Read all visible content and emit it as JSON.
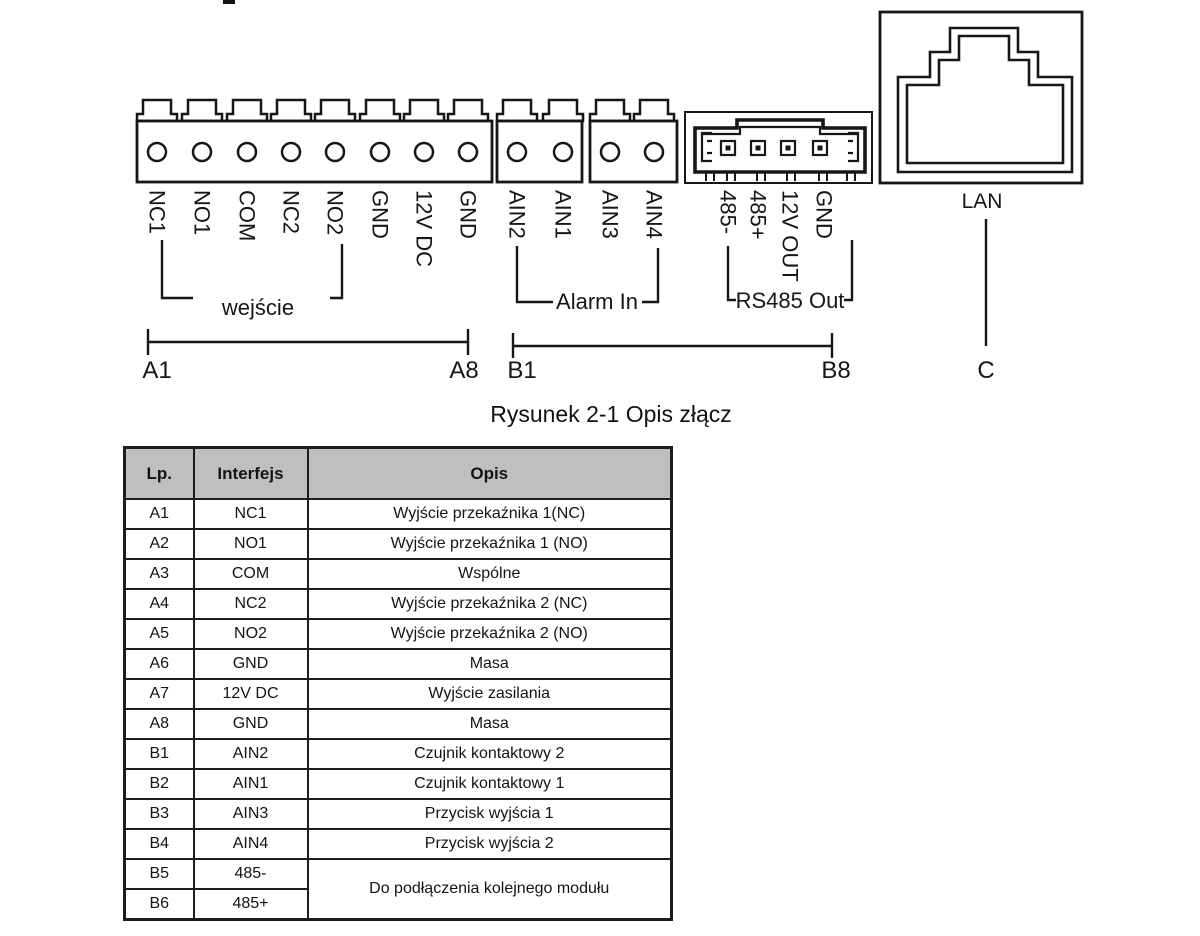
{
  "figure": {
    "caption": "Rysunek 2-1 Opis złącz",
    "connector_a": {
      "pins": [
        "NC1",
        "NO1",
        "COM",
        "NC2",
        "NO2",
        "GND",
        "12V DC",
        "GND"
      ],
      "bracket_label": "wejście"
    },
    "alarm_in": {
      "pins": [
        "AIN2",
        "AIN1",
        "AIN3",
        "AIN4"
      ],
      "bracket_label": "Alarm In"
    },
    "rs485": {
      "pins": [
        "485-",
        "485+",
        "12V OUT",
        "GND"
      ],
      "bracket_label": "RS485 Out"
    },
    "range_a": {
      "start": "A1",
      "end": "A8"
    },
    "range_b": {
      "start": "B1",
      "end": "B8"
    },
    "lan": {
      "label": "LAN",
      "range_label": "C"
    }
  },
  "table": {
    "headers": [
      "Lp.",
      "Interfejs",
      "Opis"
    ],
    "rows": [
      {
        "lp": "A1",
        "interfejs": "NC1",
        "opis": "Wyjście przekaźnika 1(NC)"
      },
      {
        "lp": "A2",
        "interfejs": "NO1",
        "opis": "Wyjście przekaźnika 1 (NO)"
      },
      {
        "lp": "A3",
        "interfejs": "COM",
        "opis": "Wspólne"
      },
      {
        "lp": "A4",
        "interfejs": "NC2",
        "opis": "Wyjście przekaźnika 2 (NC)"
      },
      {
        "lp": "A5",
        "interfejs": "NO2",
        "opis": "Wyjście przekaźnika 2 (NO)"
      },
      {
        "lp": "A6",
        "interfejs": "GND",
        "opis": "Masa"
      },
      {
        "lp": "A7",
        "interfejs": "12V DC",
        "opis": "Wyjście zasilania"
      },
      {
        "lp": "A8",
        "interfejs": "GND",
        "opis": "Masa"
      },
      {
        "lp": "B1",
        "interfejs": "AIN2",
        "opis": "Czujnik kontaktowy 2"
      },
      {
        "lp": "B2",
        "interfejs": "AIN1",
        "opis": "Czujnik kontaktowy 1"
      },
      {
        "lp": "B3",
        "interfejs": "AIN3",
        "opis": "Przycisk wyjścia 1"
      },
      {
        "lp": "B4",
        "interfejs": "AIN4",
        "opis": "Przycisk wyjścia 2"
      },
      {
        "lp": "B5",
        "interfejs": "485-",
        "opis": "Do podłączenia kolejnego modułu"
      },
      {
        "lp": "B6",
        "interfejs": "485+"
      }
    ]
  },
  "colors": {
    "table_header_bg": "#bfbfbf",
    "line": "#161616"
  }
}
